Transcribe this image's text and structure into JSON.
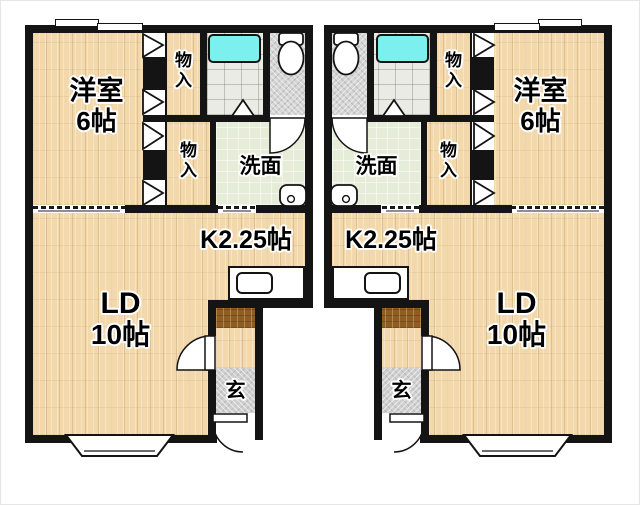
{
  "meta": {
    "drawing_type": "apartment floor plan",
    "units": 2,
    "layout": "two mirrored 1LDK units side by side"
  },
  "rooms": {
    "western": {
      "name": "洋室",
      "size": "6帖"
    },
    "closet": {
      "name": "物入"
    },
    "washroom": {
      "name": "洗面"
    },
    "kitchen": {
      "name": "K2.25帖"
    },
    "living_dining": {
      "name": "LD",
      "size": "10帖"
    },
    "entrance": {
      "name": "玄"
    }
  },
  "fixtures": {
    "bathtub": "bathtub",
    "toilet": "toilet",
    "wash_basin": "wash-basin",
    "kitchen_sink": "kitchen-sink",
    "bay_window": "bay-window",
    "sliding_window": "sliding-window"
  },
  "colors": {
    "wall": "#141414",
    "bathtub": "#7bf0ee",
    "wood_floor": "#f2d8ab",
    "washroom_floor": "#e5ecd8",
    "toilet_floor": "#d5d5d5",
    "entrance_tile": "#cfcfcf",
    "step_board": "#8d5d24"
  }
}
